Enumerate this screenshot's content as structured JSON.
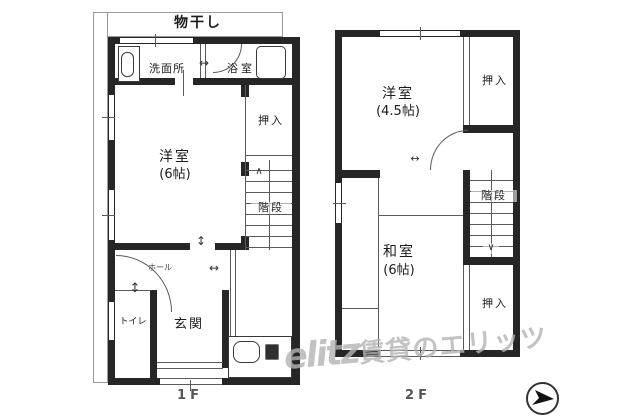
{
  "floor1": {
    "caption": "1F",
    "drying_area": "物干し",
    "washroom": "洗面所",
    "bathroom": "浴室",
    "closet": "押入",
    "room": "洋室",
    "room_size": "(6帖)",
    "stairs": "階段",
    "stairs_direction": "∧",
    "hall": "ホール",
    "toilet": "トイレ",
    "entrance": "玄関"
  },
  "floor2": {
    "caption": "2F",
    "room_west": "洋室",
    "room_west_size": "(4.5帖)",
    "closet_top": "押入",
    "stairs": "階段",
    "stairs_direction": "∨",
    "room_tatami": "和室",
    "room_tatami_size": "(6帖)",
    "closet_bottom": "押入"
  },
  "symbols": {
    "door_slide_h": "↔",
    "door_swing_v": "↕"
  },
  "watermark": {
    "logo": "elitz",
    "text": "賃貸のエリッツ"
  },
  "colors": {
    "wall": "#262626",
    "thin_line": "#5a5a5a",
    "watermark": "#b4b4b4",
    "background": "#ffffff"
  }
}
